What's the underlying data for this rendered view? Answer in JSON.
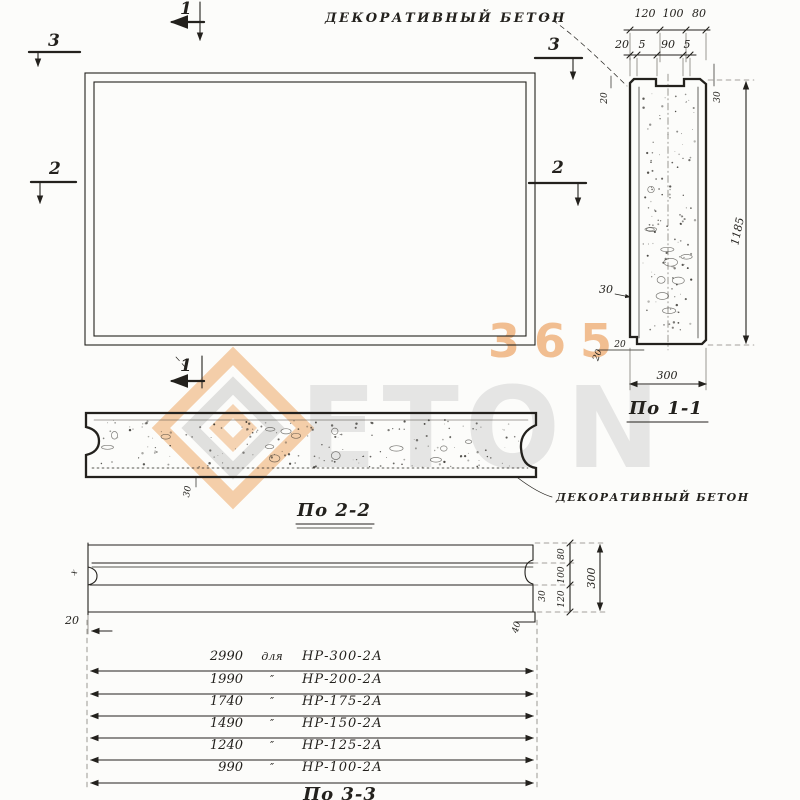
{
  "notes": {
    "top": "Декоративный бетон",
    "bottom": "Декоративный бетон"
  },
  "marks": {
    "m1": "1",
    "m2": "2",
    "m3": "3"
  },
  "sec11": {
    "label": "По 1-1",
    "dim_120": "120",
    "dim_100": "100",
    "dim_80": "80",
    "dim_20a": "20",
    "dim_5a": "5",
    "dim_90": "90",
    "dim_5b": "5",
    "dim_20_left": "20",
    "dim_30_right": "30",
    "dim_30_mid": "30",
    "dim_20_b1": "20",
    "dim_20_b2": "20",
    "dim_300": "300",
    "dim_1185": "1185"
  },
  "sec22": {
    "label": "По 2-2",
    "dim_30": "30"
  },
  "sec33": {
    "label": "По 3-3",
    "dim_80": "80",
    "dim_100": "100",
    "dim_120": "120",
    "dim_300": "300",
    "dim_30": "30",
    "dim_40": "40",
    "dim_20": "20",
    "radius_note": "х"
  },
  "table": {
    "rows": [
      {
        "len": "2990",
        "sep": "для",
        "mark": "НР-300-2А"
      },
      {
        "len": "1990",
        "sep": "″",
        "mark": "НР-200-2А"
      },
      {
        "len": "1740",
        "sep": "″",
        "mark": "НР-175-2А"
      },
      {
        "len": "1490",
        "sep": "″",
        "mark": "НР-150-2А"
      },
      {
        "len": "1240",
        "sep": "″",
        "mark": "НР-125-2А"
      },
      {
        "len": "990",
        "sep": "″",
        "mark": "НР-100-2А"
      }
    ]
  },
  "watermark": {
    "digits": "365",
    "word": "ETON"
  },
  "colors": {
    "ink": "#23211d",
    "accent_orange": "#e88a3a",
    "wm_gray": "#c9c9c9"
  }
}
